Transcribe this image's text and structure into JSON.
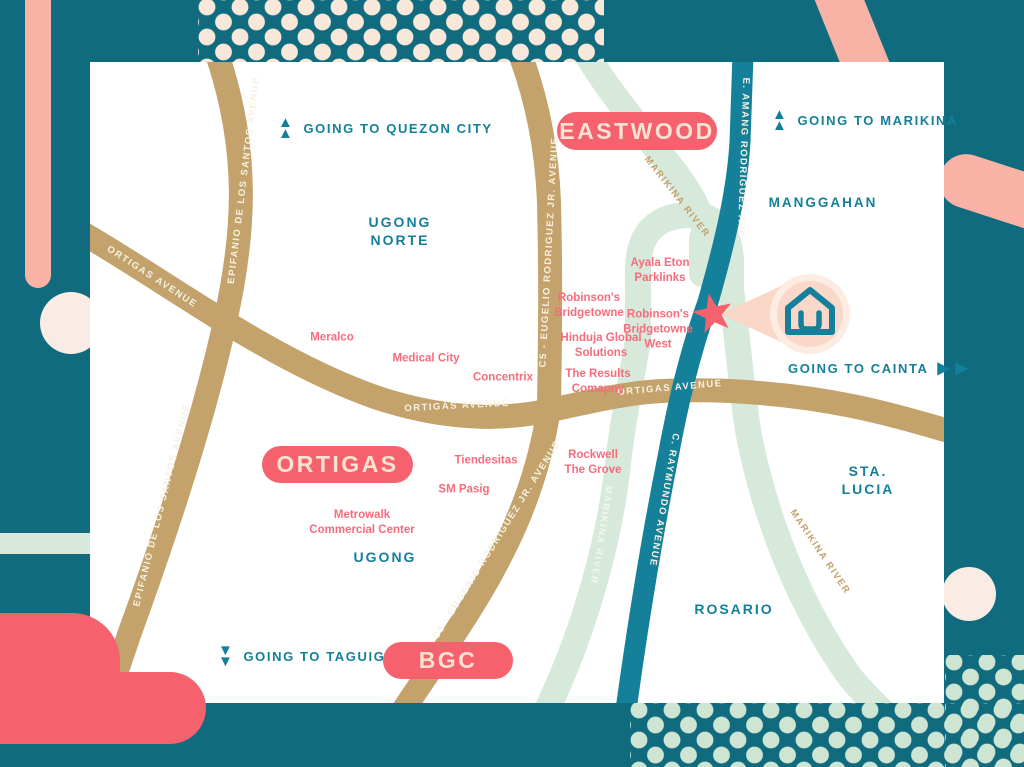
{
  "colors": {
    "background_teal": "#116b7e",
    "road_teal": "#158099",
    "text_teal": "#147f9a",
    "road_tan": "#c3a26b",
    "river_mint": "#d7e9da",
    "coral": "#f5616d",
    "salmon": "#f9b3a6",
    "cream": "#f7e8da",
    "blush": "#f8ece4",
    "pink_text": "#f76c7c"
  },
  "icons": {
    "up_arrow": "▲",
    "down_arrow": "▼",
    "right_arrow": "▶"
  },
  "badges": {
    "eastwood": "EASTWOOD",
    "ortigas": "ORTIGAS",
    "bgc": "BGC"
  },
  "directions": {
    "quezon_city": "GOING TO QUEZON CITY",
    "marikina": "GOING TO MARIKINA",
    "cainta": "GOING TO CAINTA",
    "taguig": "GOING TO TAGUIG"
  },
  "districts": {
    "ugong_norte": "UGONG\nNORTE",
    "manggahan": "MANGGAHAN",
    "ugong": "UGONG",
    "sta_lucia": "STA. LUCIA",
    "rosario": "ROSARIO"
  },
  "pois": {
    "meralco": "Meralco",
    "medical_city": "Medical City",
    "concentrix": "Concentrix",
    "ayala_eton": "Ayala Eton\nParklinks",
    "robinsons_bridgetowne": "Robinson's\nBridgetowne",
    "robinsons_bridgetowne_west": "Robinson's\nBridgetowne\nWest",
    "hinduja": "Hinduja Global\nSolutions",
    "the_results": "The Results\nComapny",
    "tiendesitas": "Tiendesitas",
    "sm_pasig": "SM Pasig",
    "metrowalk": "Metrowalk\nCommercial Center",
    "rockwell": "Rockwell\nThe Grove"
  },
  "roads": {
    "edsa_upper": "EPIFANIO DE LOS SANTOS AVENUE",
    "edsa_lower": "EPIFANIO DE LOS SANTOS AVENUE",
    "ortigas_west": "ORTIGAS AVENUE",
    "ortigas_mid": "ORTIGAS AVENUE",
    "ortigas_east": "ORTIGAS AVENUE",
    "c5_upper": "C5 - EUGELIO RODRIGUEZ JR. AVENUE",
    "c5_lower": "C5 - EUGENIO RODRIGUEZ JR. AVENUE",
    "e_amang": "E. AMANG RODRIGUEZ AVE.",
    "c_raymundo": "C. RAYMUNDO AVENUE"
  },
  "rivers": {
    "marikina_top": "MARIKINA RIVER",
    "marikina_left": "MARIKINA RIVER",
    "marikina_right": "MARIKINA RIVER"
  }
}
